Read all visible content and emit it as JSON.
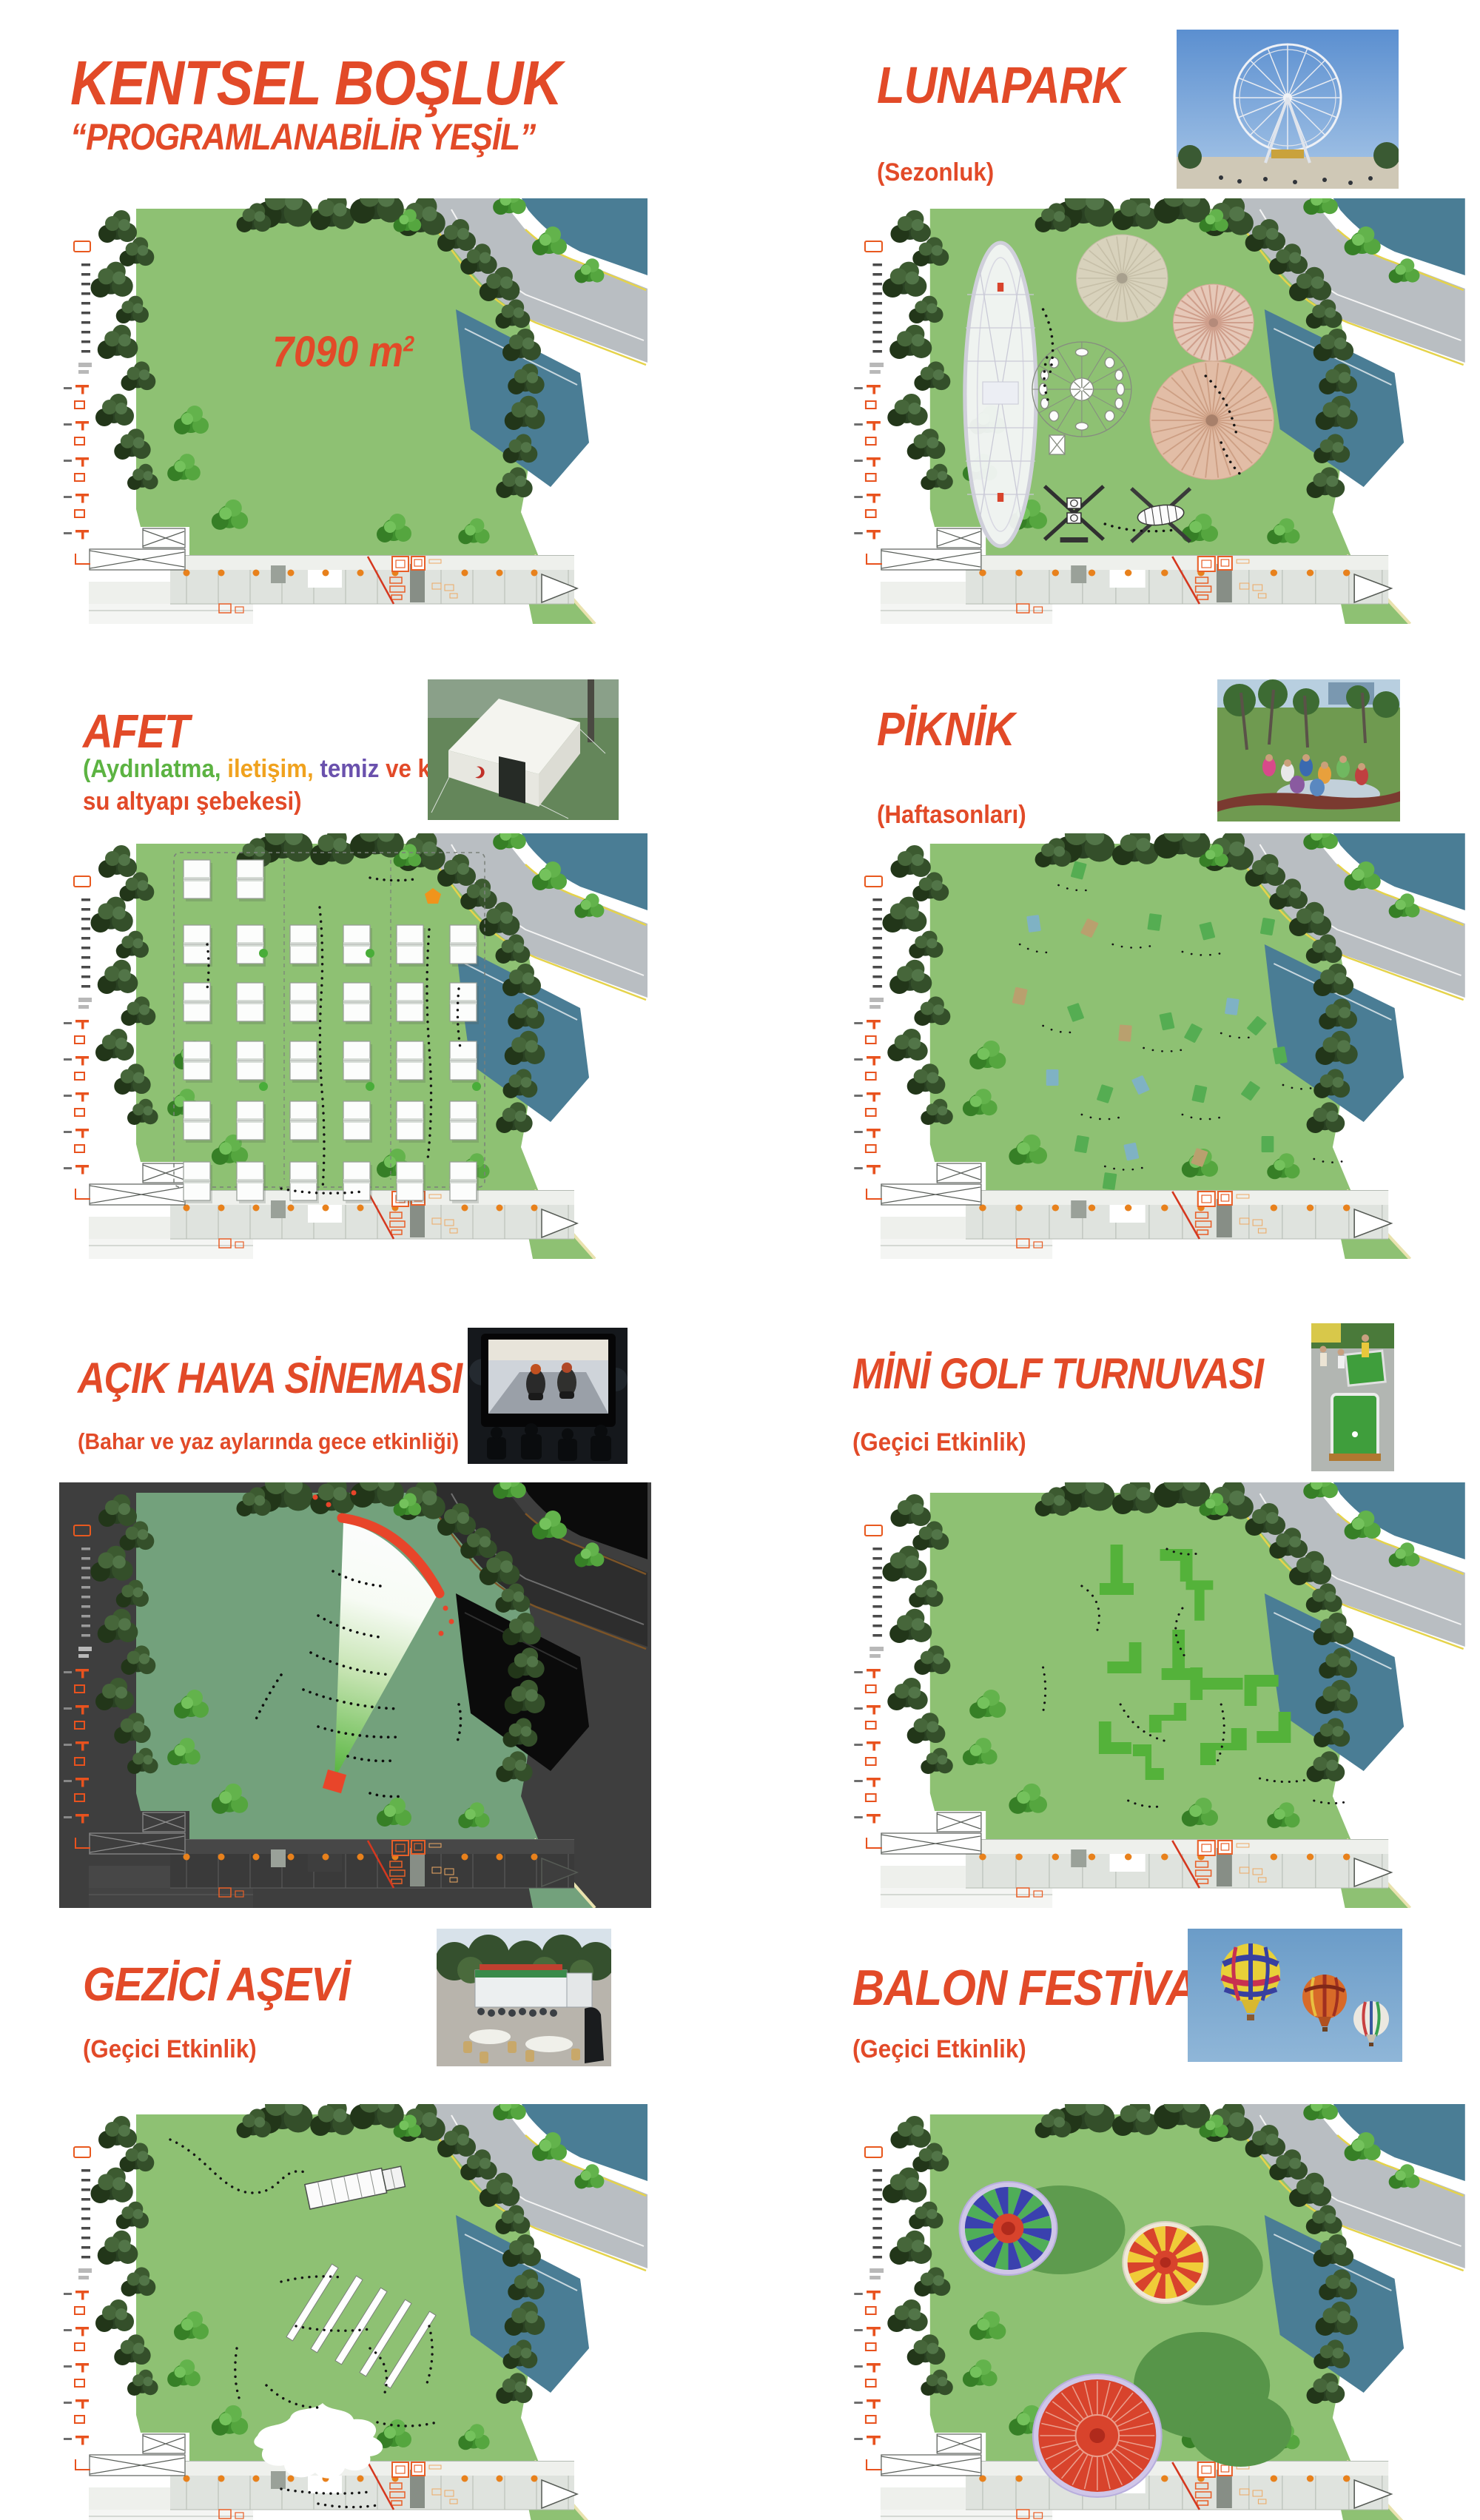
{
  "board": {
    "title": "KENTSEL BOŞLUK",
    "subtitle": "“PROGRAMLANABİLİR YEŞİL”",
    "area_value": "7090 m",
    "area_exp": "2"
  },
  "colors": {
    "accent": "#e24a28",
    "lighting_green": "#5cb342",
    "comm_amber": "#f0a21e",
    "clean_purple": "#6a51ad",
    "field_green": "#8ec173",
    "water_teal": "#4a7d95"
  },
  "panels": [
    {
      "key": "lunapark",
      "title": "LUNAPARK",
      "subtitle": "(Sezonluk)",
      "photo": "ferris-wheel"
    },
    {
      "key": "afet",
      "title": "AFET",
      "subtitle_segments": [
        {
          "text": "(Aydınlatma,",
          "color": "#5cb342"
        },
        {
          "text": " iletişim,",
          "color": "#f0a21e"
        },
        {
          "text": " temiz",
          "color": "#6a51ad"
        },
        {
          "text": " ve kirli su altyapı şebekesi)",
          "color": "#e24a28"
        }
      ],
      "photo": "relief-tent"
    },
    {
      "key": "piknik",
      "title": "PİKNİK",
      "subtitle": "(Haftasonları)",
      "photo": "picnic"
    },
    {
      "key": "sinema",
      "title": "AÇIK HAVA SİNEMASI",
      "subtitle": "(Bahar ve yaz aylarında gece etkinliği)",
      "photo": "open-air-cinema"
    },
    {
      "key": "minigolf",
      "title": "MİNİ GOLF TURNUVASI",
      "subtitle": "(Geçici Etkinlik)",
      "photo": "mini-golf"
    },
    {
      "key": "asevi",
      "title": "GEZİCİ AŞEVİ",
      "subtitle": "(Geçici Etkinlik)",
      "photo": "mobile-kitchen"
    },
    {
      "key": "balon",
      "title": "BALON FESTİVALİ",
      "subtitle": "(Geçici Etkinlik)",
      "photo": "hot-air-balloons"
    }
  ]
}
